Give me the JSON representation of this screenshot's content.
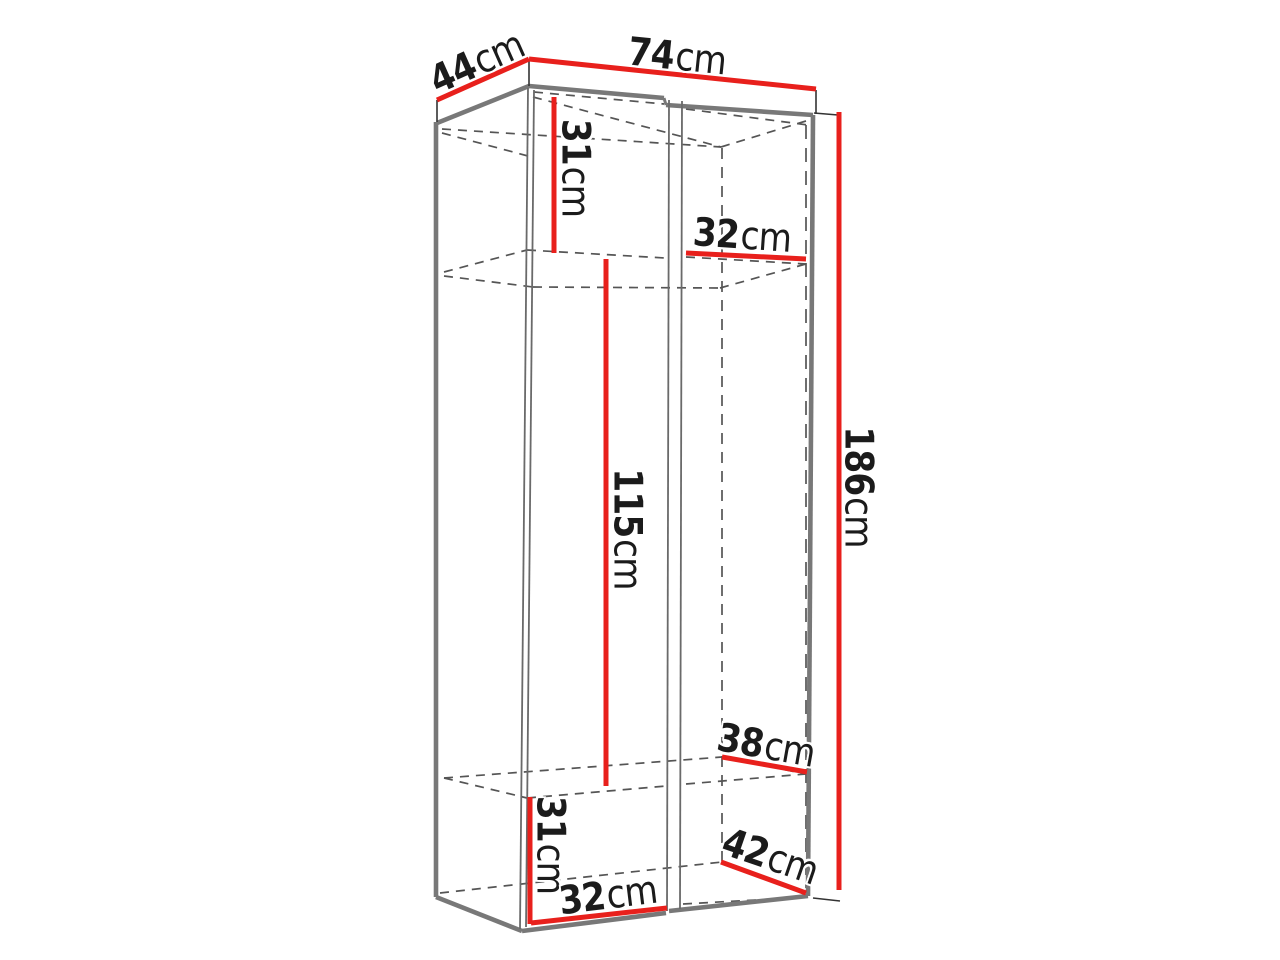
{
  "diagram": {
    "title": "Wardrobe dimension drawing",
    "unit": "cm",
    "dimensions": {
      "top_depth": {
        "value": "44",
        "unit": "cm"
      },
      "top_width": {
        "value": "74",
        "unit": "cm"
      },
      "upper_section_height": {
        "value": "31",
        "unit": "cm"
      },
      "upper_shelf_width": {
        "value": "32",
        "unit": "cm"
      },
      "middle_section_height": {
        "value": "115",
        "unit": "cm"
      },
      "overall_height": {
        "value": "186",
        "unit": "cm"
      },
      "lower_shelf_depth": {
        "value": "38",
        "unit": "cm"
      },
      "lower_section_height": {
        "value": "31",
        "unit": "cm"
      },
      "floor_depth": {
        "value": "42",
        "unit": "cm"
      },
      "lower_section_width": {
        "value": "32",
        "unit": "cm"
      }
    },
    "colors": {
      "dimension_line": "#e8201c",
      "visible_edge": "#787878",
      "door_edge": "#6a6a6a",
      "hidden_edge": "#555555",
      "extension_tick": "#333333",
      "label_text": "#1b1b1b",
      "background": "#ffffff"
    }
  }
}
